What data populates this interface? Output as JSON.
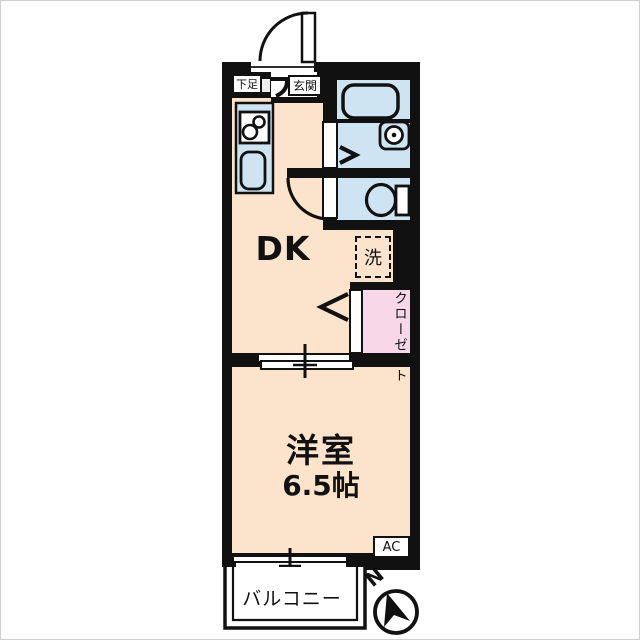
{
  "colors": {
    "wall": "#111111",
    "floor": "#fce3cb",
    "water_blue": "#cee4f2",
    "closet_pink": "#f8d8e8",
    "white": "#ffffff",
    "genkan_gray": "#ececec"
  },
  "labels": {
    "dk": "DK",
    "bedroom": "洋室",
    "bedroom_size": "6.5帖",
    "entrance": "玄関",
    "shoe_cabinet": "下足",
    "laundry": "洗",
    "closet": "クローゼット",
    "balcony": "バルコニー",
    "ac": "AC",
    "compass_north": "N"
  }
}
